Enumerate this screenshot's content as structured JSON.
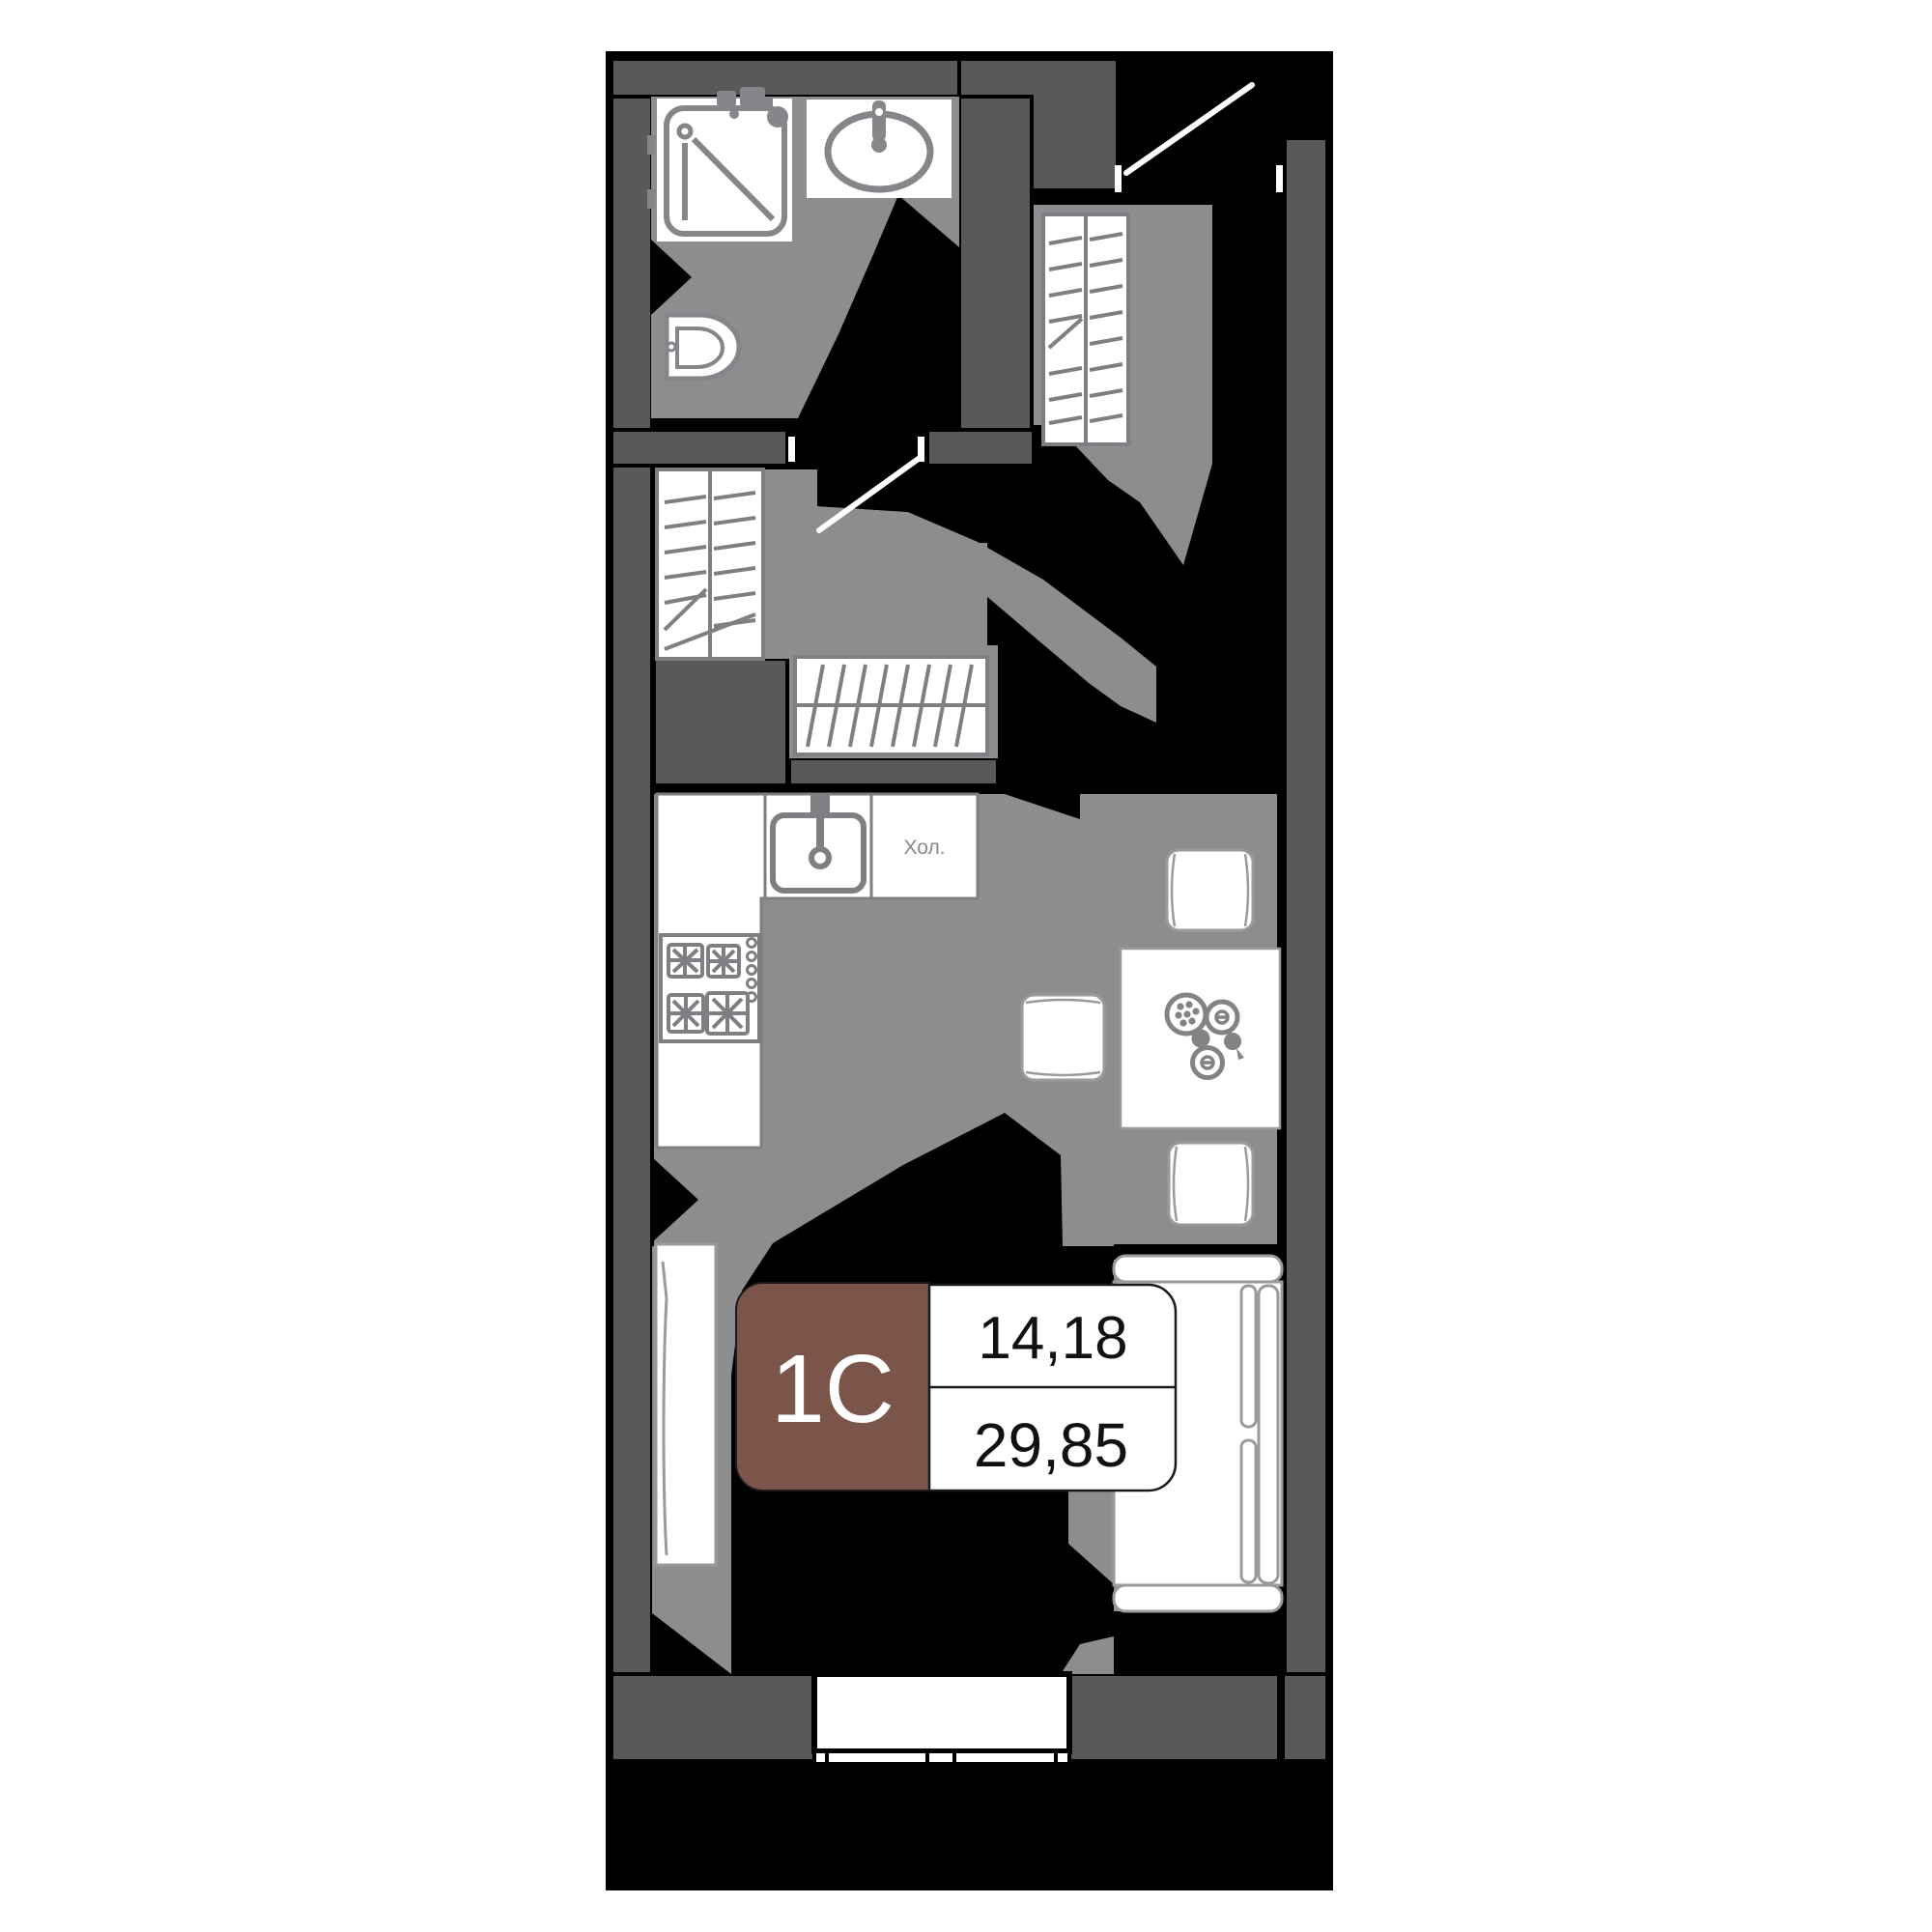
{
  "page": {
    "background": "#ffffff"
  },
  "floorplan": {
    "kind": "studio-apartment-floor-plan",
    "unit_badge": {
      "type_label": "1С",
      "upper_area": "14,18",
      "lower_area": "29,85",
      "badge_color": "#7c554a"
    },
    "room_labels": {
      "fridge_label": "Хол."
    },
    "colors": {
      "outer_wall": "#595959",
      "floor": "#8d8d8f",
      "shadow": "#000000",
      "fixture_stroke": "#85858a",
      "hatch_stroke": "#7f7f83",
      "furniture_stroke": "#9a9a9e",
      "badge_brown": "#7c554a",
      "area_text": "#111111",
      "fridge_text": "#8a8a8a",
      "white": "#ffffff"
    },
    "fixtures": [
      "shower-tray-icon",
      "bathroom-sink-icon",
      "toilet-icon",
      "hall-wardrobe-hatch-icon",
      "entry-wardrobe-hatch-icon",
      "rug-hatch-icon",
      "kitchen-counter",
      "kitchen-sink-icon",
      "stove-icon",
      "fridge-zone",
      "dining-table-icon",
      "chair-icon",
      "table-decor-plates-icon",
      "sofa-bed-icon",
      "sideboard-icon",
      "balcony-window-icon",
      "entry-door-swing-icon",
      "interior-door-swing-icon"
    ]
  }
}
